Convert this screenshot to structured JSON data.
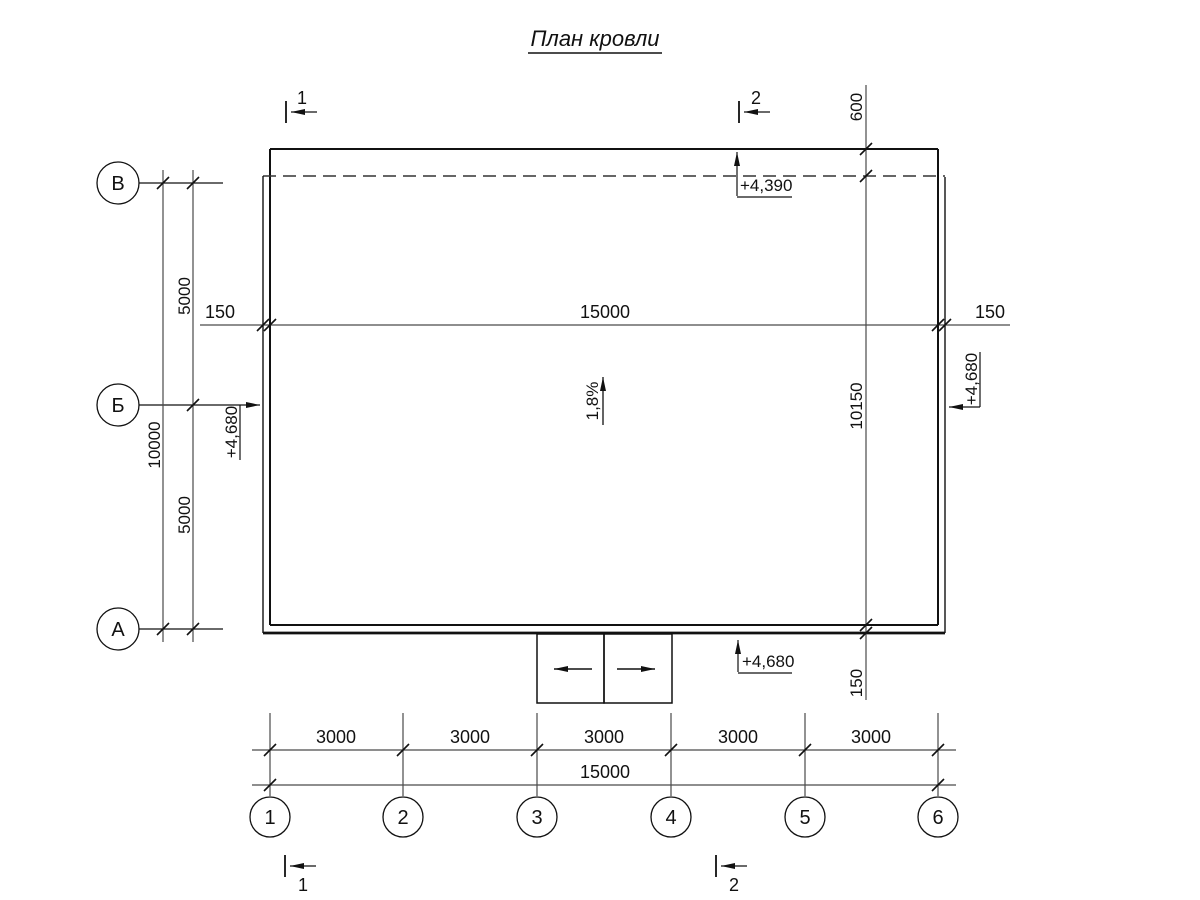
{
  "title": {
    "text": "План кровли"
  },
  "colors": {
    "ink": "#111111",
    "dim_lines": "#4a4a4a",
    "background": "#ffffff"
  },
  "grid": {
    "rows": [
      {
        "label": "В"
      },
      {
        "label": "Б"
      },
      {
        "label": "А"
      }
    ],
    "cols": [
      {
        "label": "1"
      },
      {
        "label": "2"
      },
      {
        "label": "3"
      },
      {
        "label": "4"
      },
      {
        "label": "5"
      },
      {
        "label": "6"
      }
    ]
  },
  "sections": {
    "top_left": "1",
    "top_right": "2",
    "bottom_left": "1",
    "bottom_right": "2"
  },
  "dims": {
    "top_left_overhang": "150",
    "top_span": "15000",
    "top_right_overhang": "150",
    "left_upper": "5000",
    "left_total": "10000",
    "left_lower": "5000",
    "right_top": "600",
    "right_middle": "10150",
    "right_bottom": "150",
    "bottom_bays": [
      "3000",
      "3000",
      "3000",
      "3000",
      "3000"
    ],
    "bottom_total": "15000"
  },
  "elevations": {
    "roof_top": "+4,390",
    "left": "+4,680",
    "right": "+4,680",
    "bottom": "+4,680"
  },
  "slope": {
    "value": "1,8%"
  }
}
